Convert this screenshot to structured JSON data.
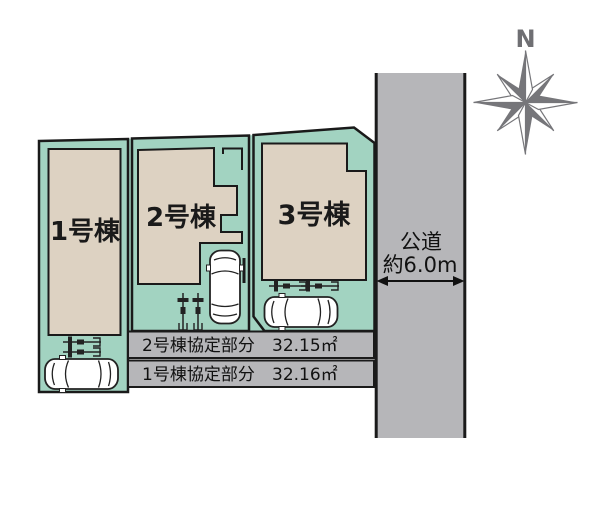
{
  "diagram": {
    "compass": {
      "north_label": "N"
    },
    "road": {
      "name": "公道",
      "width_label": "約6.0m"
    },
    "plots": [
      {
        "label": "1号棟"
      },
      {
        "label": "2号棟"
      },
      {
        "label": "3号棟"
      }
    ],
    "agreement_table": [
      {
        "label": "2号棟協定部分",
        "area": "32.15㎡"
      },
      {
        "label": "1号棟協定部分",
        "area": "32.16㎡"
      }
    ],
    "colors": {
      "plot_fill": "#a2d3c1",
      "building_fill": "#ddd2c2",
      "road_fill": "#b6b6b9",
      "outline": "#1a1a1a",
      "compass_gray": "#76767a"
    }
  }
}
